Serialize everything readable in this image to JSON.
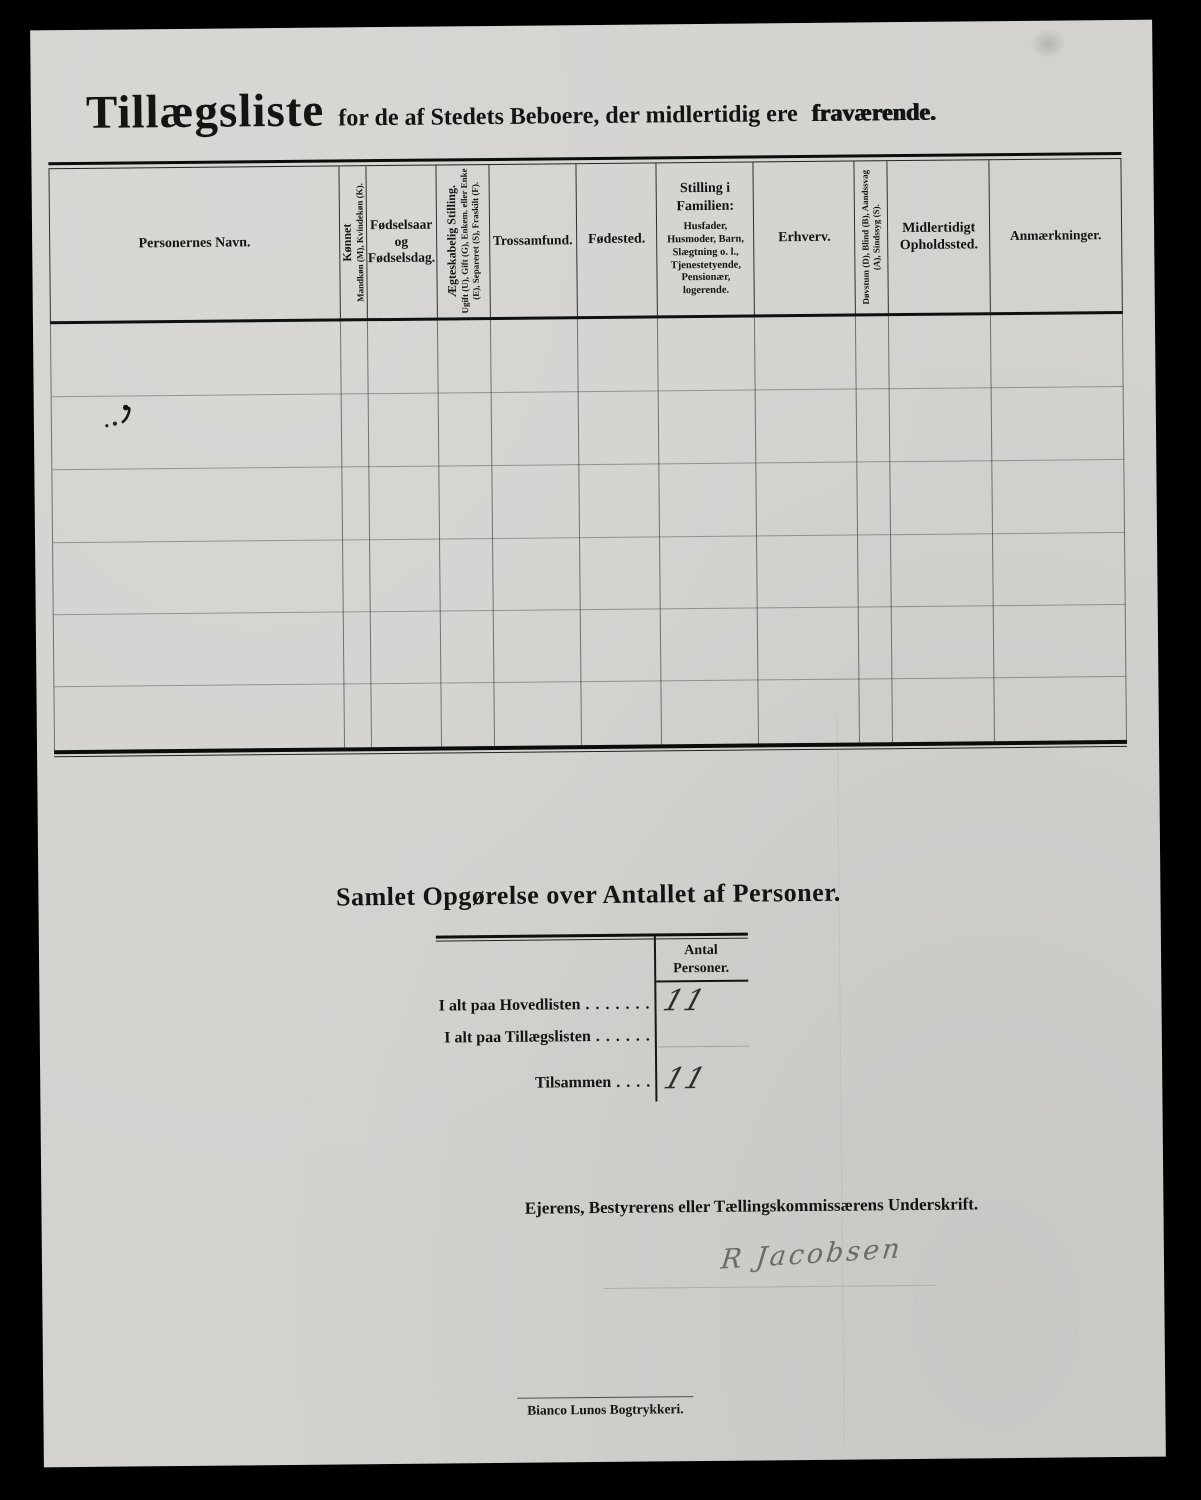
{
  "document": {
    "title": "Tillægsliste",
    "title_subtitle": "for de af Stedets Beboere, der midlertidig ere",
    "title_emphasis": "fraværende."
  },
  "table": {
    "columns": [
      {
        "label": "Personernes Navn."
      },
      {
        "label_top": "Kønnet",
        "label_sub": "Mandkøn (M), Kvindekøn (K)."
      },
      {
        "label": "Fødselsaar og Fødselsdag."
      },
      {
        "label_top": "Ægteskabelig Stilling.",
        "label_sub": "Ugift (U), Gift (G), Enkem. eller Enke (E), Separeret (S), Fraskilt (F)."
      },
      {
        "label": "Trossamfund."
      },
      {
        "label": "Fødested."
      },
      {
        "label": "Stilling i Familien:",
        "label_sub": "Husfader, Husmoder, Barn, Slægtning o. l., Tjenestetyende, Pensionær, logerende."
      },
      {
        "label": "Erhverv."
      },
      {
        "label": "Døvstum (D), Blind (B), Aandssvag (A), Sindssyg (S)."
      },
      {
        "label": "Midlertidigt Opholdssted."
      },
      {
        "label": "Anmærkninger."
      }
    ],
    "row_count": 6
  },
  "summary": {
    "title": "Samlet Opgørelse over Antallet af Personer.",
    "column_header": "Antal Personer.",
    "rows": [
      {
        "label": "I alt paa Hovedlisten",
        "dots": " . . . . . . .",
        "value": "11"
      },
      {
        "label": "I alt paa Tillægslisten",
        "dots": " . . . . . .",
        "value": ""
      },
      {
        "label": "Tilsammen",
        "dots": " . . . .",
        "value": "11"
      }
    ]
  },
  "signature": {
    "caption": "Ejerens, Bestyrerens eller Tællingskommissærens Underskrift.",
    "name": "R Jacobsen"
  },
  "footer": {
    "printer": "Bianco Lunos Bogtrykkeri."
  },
  "colors": {
    "background": "#000000",
    "paper": "#d3d2cf",
    "ink": "#141412",
    "faint_line": "#8f8f8a",
    "handwriting": "#4a4a46"
  }
}
